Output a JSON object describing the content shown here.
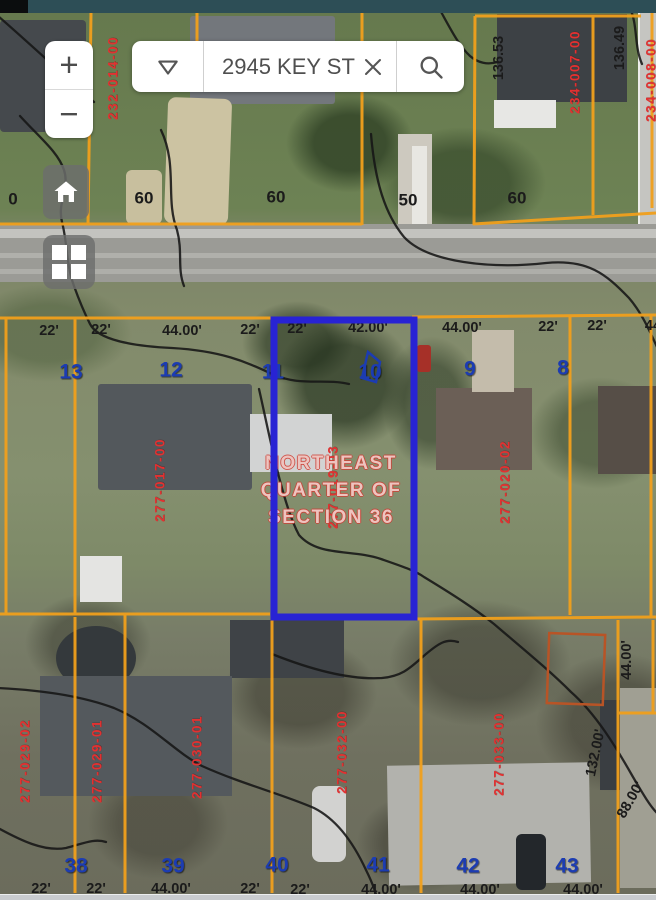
{
  "chrome": {
    "top_bar_color": "#2d4e56",
    "bottom_bar_color": "#c9cccf"
  },
  "controls": {
    "zoom_in_label": "+",
    "zoom_out_label": "−",
    "search_value": "2945 KEY ST",
    "icons": [
      "dropdown-chevron",
      "clear-x",
      "magnifier",
      "home",
      "layers-grid"
    ],
    "colors": {
      "parcel_line": "#f1a01c",
      "selection_outline": "#2823d4",
      "parcel_number_text": "#e23131",
      "lot_number_text": "#1c3cb2"
    }
  },
  "map_labels": {
    "survey": [
      "NORTHEAST",
      "QUARTER OF",
      "SECTION 36"
    ],
    "parcel_numbers": [
      {
        "text": "232-014-00",
        "x": 113,
        "y": 78,
        "angle": -90
      },
      {
        "text": "234-007-00",
        "x": 575,
        "y": 72,
        "angle": -90
      },
      {
        "text": "234-008-00",
        "x": 651,
        "y": 80,
        "angle": -90
      },
      {
        "text": "277-017-00",
        "x": 160,
        "y": 480,
        "angle": -90
      },
      {
        "text": "277-019-03",
        "x": 333,
        "y": 487,
        "angle": -90
      },
      {
        "text": "277-020-02",
        "x": 505,
        "y": 482,
        "angle": -90
      },
      {
        "text": "277-029-02",
        "x": 25,
        "y": 761,
        "angle": -90
      },
      {
        "text": "277-029-01",
        "x": 97,
        "y": 761,
        "angle": -90
      },
      {
        "text": "277-030-01",
        "x": 197,
        "y": 757,
        "angle": -90
      },
      {
        "text": "277-032-00",
        "x": 342,
        "y": 752,
        "angle": -90
      },
      {
        "text": "277-033-00",
        "x": 499,
        "y": 754,
        "angle": -90
      }
    ],
    "survey_measurements": [
      {
        "text": "136.53",
        "x": 499,
        "y": 58,
        "angle": -90
      },
      {
        "text": "136.49",
        "x": 620,
        "y": 48,
        "angle": -90
      },
      {
        "text": "44.00'",
        "x": 627,
        "y": 660,
        "angle": -90
      },
      {
        "text": "132.00'",
        "x": 596,
        "y": 753,
        "angle": -78
      },
      {
        "text": "88.00'",
        "x": 631,
        "y": 800,
        "angle": -60
      }
    ],
    "road_numbers": [
      {
        "text": "0",
        "x": 13,
        "y": 199
      },
      {
        "text": "60",
        "x": 144,
        "y": 198
      },
      {
        "text": "60",
        "x": 276,
        "y": 197
      },
      {
        "text": "50",
        "x": 408,
        "y": 200
      },
      {
        "text": "60",
        "x": 517,
        "y": 198
      }
    ],
    "lot_numbers": [
      {
        "text": "13",
        "x": 71,
        "y": 372
      },
      {
        "text": "12",
        "x": 171,
        "y": 370
      },
      {
        "text": "11",
        "x": 273,
        "y": 372
      },
      {
        "text": "10",
        "x": 370,
        "y": 372
      },
      {
        "text": "9",
        "x": 470,
        "y": 369
      },
      {
        "text": "8",
        "x": 563,
        "y": 368
      },
      {
        "text": "38",
        "x": 76,
        "y": 866
      },
      {
        "text": "39",
        "x": 173,
        "y": 866
      },
      {
        "text": "40",
        "x": 277,
        "y": 865
      },
      {
        "text": "41",
        "x": 378,
        "y": 865
      },
      {
        "text": "42",
        "x": 468,
        "y": 866
      },
      {
        "text": "43",
        "x": 567,
        "y": 866
      }
    ],
    "frontage_dims": [
      {
        "text": "22'",
        "x": 49,
        "y": 331
      },
      {
        "text": "22'",
        "x": 101,
        "y": 330
      },
      {
        "text": "44.00'",
        "x": 182,
        "y": 331
      },
      {
        "text": "22'",
        "x": 250,
        "y": 330
      },
      {
        "text": "22'",
        "x": 297,
        "y": 329
      },
      {
        "text": "42.00'",
        "x": 368,
        "y": 328
      },
      {
        "text": "44.00'",
        "x": 462,
        "y": 328
      },
      {
        "text": "22'",
        "x": 548,
        "y": 327
      },
      {
        "text": "22'",
        "x": 597,
        "y": 326
      },
      {
        "text": "44",
        "x": 653,
        "y": 326
      },
      {
        "text": "22'",
        "x": 41,
        "y": 889
      },
      {
        "text": "22'",
        "x": 96,
        "y": 889
      },
      {
        "text": "44.00'",
        "x": 171,
        "y": 889
      },
      {
        "text": "22'",
        "x": 250,
        "y": 889
      },
      {
        "text": "22'",
        "x": 300,
        "y": 890
      },
      {
        "text": "44.00'",
        "x": 381,
        "y": 890
      },
      {
        "text": "44.00'",
        "x": 480,
        "y": 890
      },
      {
        "text": "44.00'",
        "x": 583,
        "y": 890
      }
    ]
  }
}
